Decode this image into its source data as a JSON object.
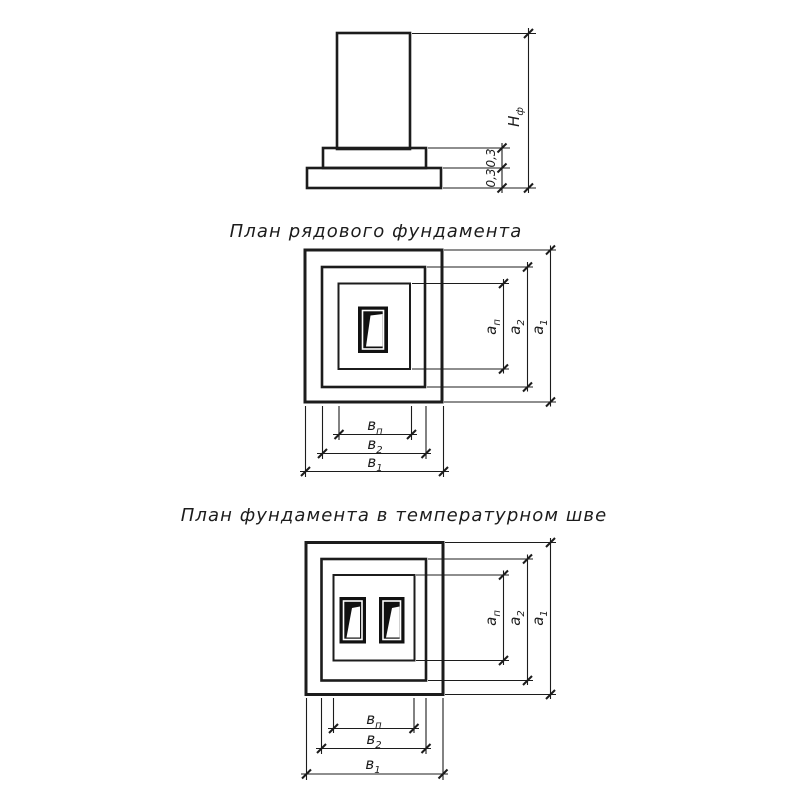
{
  "drawing": {
    "ink_color": "#1c1c1c",
    "background_color": "#ffffff"
  },
  "elevation": {
    "height_dim": {
      "base": "Н",
      "sub": "ф"
    },
    "step_dims": [
      "0,3",
      "0,3"
    ]
  },
  "plan_ordinary": {
    "title": "План рядового фундамента",
    "width_dims_right": [
      {
        "base": "а",
        "sub": "п"
      },
      {
        "base": "а",
        "sub": "2"
      },
      {
        "base": "а",
        "sub": "1"
      }
    ],
    "width_dims_bottom": [
      {
        "base": "в",
        "sub": "п"
      },
      {
        "base": "в",
        "sub": "2"
      },
      {
        "base": "в",
        "sub": "1"
      }
    ]
  },
  "plan_joint": {
    "title": "План фундамента в температурном шве",
    "width_dims_right": [
      {
        "base": "а",
        "sub": "п"
      },
      {
        "base": "а",
        "sub": "2"
      },
      {
        "base": "а",
        "sub": "1"
      }
    ],
    "width_dims_bottom": [
      {
        "base": "в",
        "sub": "п"
      },
      {
        "base": "в",
        "sub": "2"
      },
      {
        "base": "в",
        "sub": "1"
      }
    ]
  }
}
